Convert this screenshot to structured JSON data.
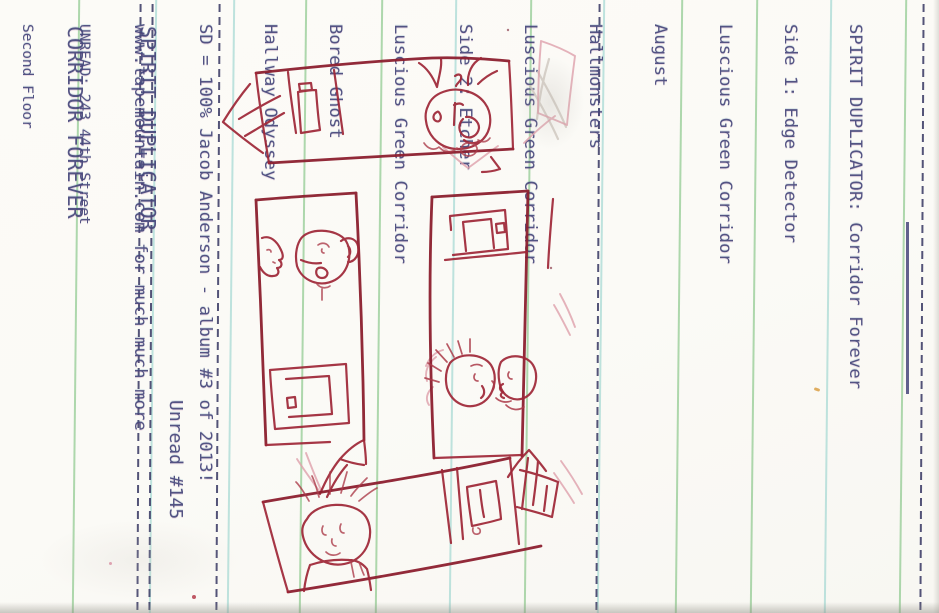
{
  "document": {
    "kind": "Scanned cassette J-card insert, printed text rotated 90 degrees on ruled paper"
  },
  "tracklist": {
    "title_artist": "SPIRIT DUPLICATOR: ",
    "title_album": "Corridor Forever",
    "lines": [
      "Side 1: Edge Detector",
      "Luscious Green Corridor",
      "August",
      "Hallmonsters",
      "Luscious Green Corridor",
      "Side 2: Etcher",
      "Luscious Green Corridor",
      "Bored Ghost",
      "Hallway Odyssey",
      "SD = 100% Jacob Anderson - album #3 of 2013!",
      "www.tapemountain.com for much much more"
    ]
  },
  "spine": {
    "artist": "SPIRIT DUPLICATOR",
    "album": "CORRIDOR FOREVER",
    "catalog_number": "Unread #145"
  },
  "back_panel": {
    "address_lines": [
      "UNREAD: 243 44th Street",
      "Second Floor",
      "Pittsburgh PA 15201",
      "www.unread-records.com"
    ]
  },
  "cover_drawing": {
    "medium": "hand-drawn red ink sketch",
    "description": "Maze of four corridors with doors, directional arrows, three ghosts and a walking person"
  },
  "colors": {
    "ink": "#45457a",
    "drawing_red": "#9e2636",
    "drawing_pink": "#dfa0ab",
    "pencil_grey": "#cfc8bf",
    "rule_green": "#8fc98f",
    "rule_teal": "#a5d8d2",
    "fold_navy": "#3c3c66",
    "paper": "#fbfaf6"
  }
}
